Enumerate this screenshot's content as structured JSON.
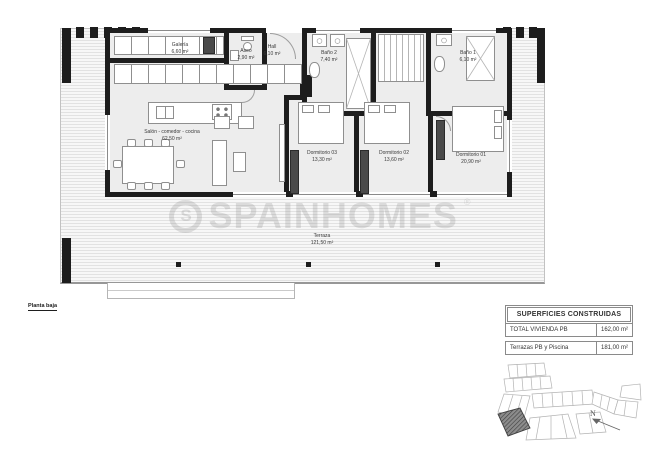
{
  "plan": {
    "floor_label": "Planta baja",
    "rooms": [
      {
        "name": "Galería",
        "area": "6,60 m²"
      },
      {
        "name": "Aseo",
        "area": "2,90 m²"
      },
      {
        "name": "Hall",
        "area": "6,10 m²"
      },
      {
        "name": "Baño 2",
        "area": "7,40 m²"
      },
      {
        "name": "Baño 1",
        "area": "6,10 m²"
      },
      {
        "name": "Salón - comedor - cocina",
        "area": "62,50 m²"
      },
      {
        "name": "Dormitorio 03",
        "area": "13,30 m²"
      },
      {
        "name": "Dormitorio 02",
        "area": "13,60 m²"
      },
      {
        "name": "Dormitorio 01",
        "area": "20,90 m²"
      },
      {
        "name": "Terraza",
        "area": "121,50 m²"
      }
    ]
  },
  "watermark": {
    "logo_letter": "S",
    "text": "SPAINHOMES",
    "registered": "®"
  },
  "summary_table": {
    "header": "SUPERFICIES CONSTRUIDAS",
    "rows": [
      {
        "label": "TOTAL VIVIENDA PB",
        "value": "162,00 m²"
      },
      {
        "label": "Terrazas PB y Piscina",
        "value": "181,00 m²"
      }
    ]
  },
  "site_plan": {
    "north_label": "N"
  },
  "colors": {
    "wall": "#1d1d1d",
    "terrace_line": "#e2e2e2",
    "highlight_parcel": "#8c8c8c"
  }
}
